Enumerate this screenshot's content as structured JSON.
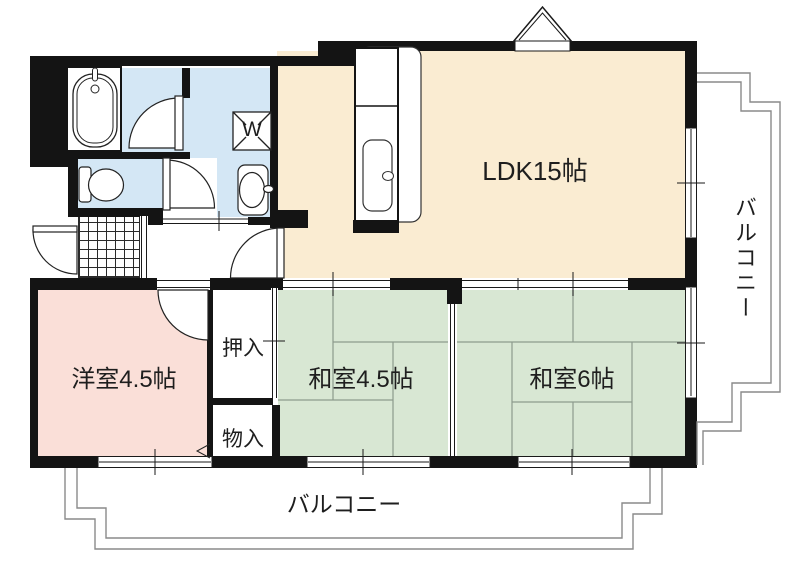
{
  "rooms": {
    "ldk": {
      "label": "LDK15帖"
    },
    "japanese_room_45": {
      "label": "和室4.5帖"
    },
    "japanese_room_6": {
      "label": "和室6帖"
    },
    "western_room": {
      "label": "洋室4.5帖"
    }
  },
  "closets": {
    "oshiire": {
      "label": "押入"
    },
    "monoire": {
      "label": "物入"
    }
  },
  "balconies": {
    "right": {
      "label": "バルコニー"
    },
    "bottom": {
      "label": "バルコニー"
    }
  },
  "fixtures": {
    "washing_machine_label": "W"
  },
  "colors": {
    "ldk_floor": "#FAECD2",
    "tatami_floor": "#D8E7D3",
    "western_floor": "#FADFD8",
    "wet_area_floor": "#D4E7F5",
    "wall": "#141414",
    "tatami_line": "#8D9B8D",
    "balcony_line": "#8A8A8A",
    "text": "#1E1E1E"
  }
}
